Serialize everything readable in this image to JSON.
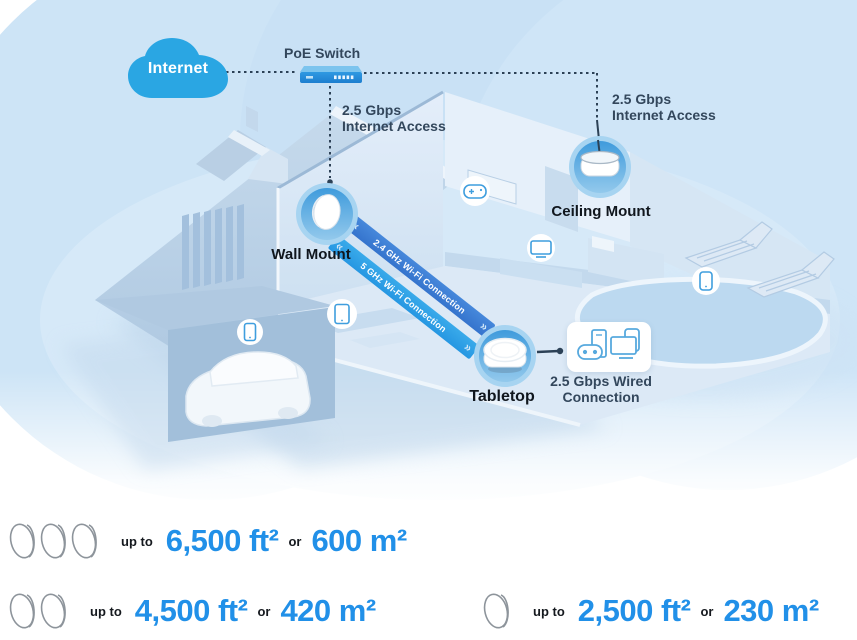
{
  "palette": {
    "cloud_blue": "#2aa6e3",
    "ribbon_24_blue": "#3d7fd6",
    "ribbon_5_blue": "#2fa2e7",
    "line_navy": "#2c4156",
    "label_navy": "#33475c",
    "label_dark": "#10161d",
    "stat_number_blue": "#2190e8",
    "node_ring_blue": "#a7d4f1",
    "node_disc_blue": "#47a2de"
  },
  "diagram": {
    "internet_label": "Internet",
    "poe_switch_label": "PoE Switch",
    "wall_access": {
      "line1": "2.5 Gbps",
      "line2": "Internet Access"
    },
    "ceiling_access": {
      "line1": "2.5 Gbps",
      "line2": "Internet Access"
    },
    "nodes": {
      "wall": "Wall Mount",
      "ceiling": "Ceiling Mount",
      "tabletop": "Tabletop"
    },
    "wired": {
      "line1": "2.5 Gbps Wired",
      "line2": "Connection"
    },
    "ribbons": {
      "band_24": "2.4 GHz Wi-Fi Connection",
      "band_5": "5 GHz Wi-Fi Connection",
      "chevron_left": "«",
      "chevron_right": "»"
    },
    "scene_icons": [
      "internet-cloud-icon",
      "poe-switch-icon",
      "mesh-unit-wall-icon",
      "mesh-unit-ceiling-icon",
      "mesh-unit-tabletop-icon",
      "smartphone-icon",
      "tablet-icon",
      "game-controller-icon",
      "tv-icon",
      "smartphone-outdoor-icon",
      "wired-devices-icon"
    ]
  },
  "stats": {
    "rows": [
      {
        "units": 3,
        "upto": "up to",
        "imperial": "6,500 ft²",
        "conj": "or",
        "metric": "600 m²"
      },
      {
        "units": 2,
        "upto": "up to",
        "imperial": "4,500 ft²",
        "conj": "or",
        "metric": "420 m²"
      },
      {
        "units": 1,
        "upto": "up to",
        "imperial": "2,500 ft²",
        "conj": "or",
        "metric": "230 m²"
      }
    ]
  }
}
